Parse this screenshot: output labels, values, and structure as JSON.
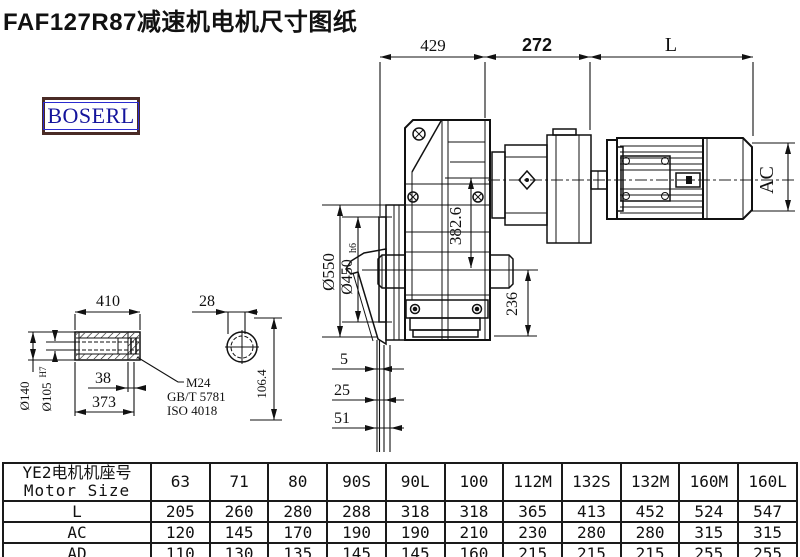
{
  "title": "FAF127R87减速机电机尺寸图纸",
  "logo": "BOSERL",
  "dims": {
    "d429": "429",
    "d272": "272",
    "dL": "L",
    "d550": "Ø550",
    "d450": "Ø450",
    "d450t": "h6",
    "d382": "382.6",
    "d236": "236",
    "dAC": "AC",
    "d410": "410",
    "d28": "28",
    "d140": "Ø140",
    "d105": "Ø105",
    "d105t": "H7",
    "d38": "38",
    "d373": "373",
    "m24": "M24",
    "std1": "GB/T 5781",
    "std2": "ISO 4018",
    "d106": "106.4",
    "f5": "5",
    "f25": "25",
    "f51": "51"
  },
  "table": {
    "header_cn": "YE2电机机座号",
    "header_en": "Motor Size",
    "columns": [
      "63",
      "71",
      "80",
      "90S",
      "90L",
      "100",
      "112M",
      "132S",
      "132M",
      "160M",
      "160L"
    ],
    "rows": [
      {
        "label": "L",
        "values": [
          "205",
          "260",
          "280",
          "288",
          "318",
          "318",
          "365",
          "413",
          "452",
          "524",
          "547"
        ]
      },
      {
        "label": "AC",
        "values": [
          "120",
          "145",
          "170",
          "190",
          "190",
          "210",
          "230",
          "280",
          "280",
          "315",
          "315"
        ]
      },
      {
        "label": "AD",
        "values": [
          "110",
          "130",
          "135",
          "145",
          "145",
          "160",
          "215",
          "215",
          "215",
          "255",
          "255"
        ]
      }
    ]
  }
}
